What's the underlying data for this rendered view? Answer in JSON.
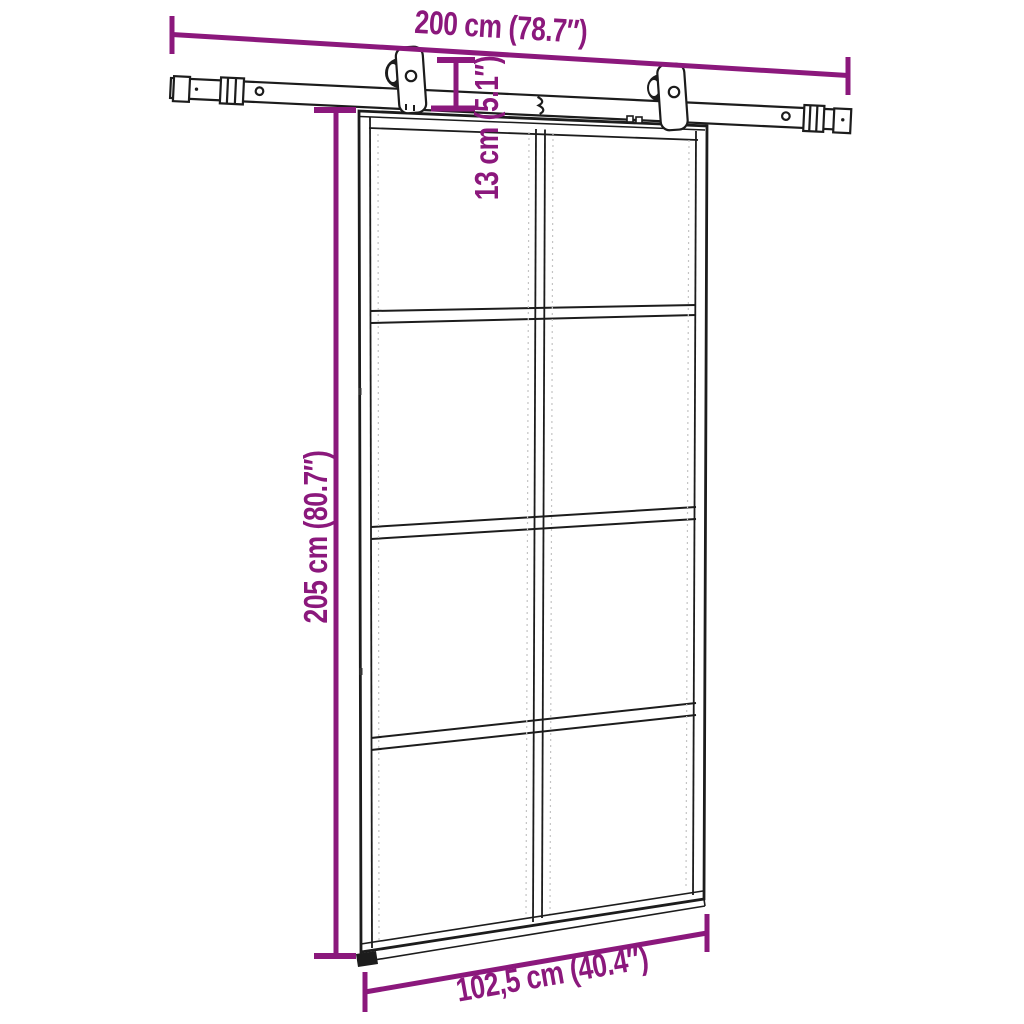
{
  "diagram": {
    "type": "product-dimension-diagram",
    "product": "Sliding glass door with sliding hardware kit",
    "background_color": "#ffffff",
    "line_color": "#1c1c1c",
    "accent_color": "#8b187c",
    "door": {
      "panel_rows": 4,
      "panel_columns": 2,
      "parts": [
        "sliding-rail",
        "rail-end-cap-left",
        "rail-end-cap-right",
        "roller-hanger-left",
        "roller-hanger-right",
        "glass-door",
        "floor-guide"
      ]
    },
    "dimensions": {
      "rail_length": {
        "label": "200 cm (78.7″)",
        "value_cm": "200 cm",
        "value_inch": "78.7″"
      },
      "rail_drop": {
        "label": "13 cm (5.1″)",
        "value_cm": "13 cm",
        "value_inch": "5.1″"
      },
      "door_height": {
        "label": "205 cm (80.7″)",
        "value_cm": "205 cm",
        "value_inch": "80.7″"
      },
      "door_width": {
        "label": "102,5 cm (40.4″)",
        "value_cm": "102,5 cm",
        "value_inch": "40.4″"
      }
    }
  }
}
